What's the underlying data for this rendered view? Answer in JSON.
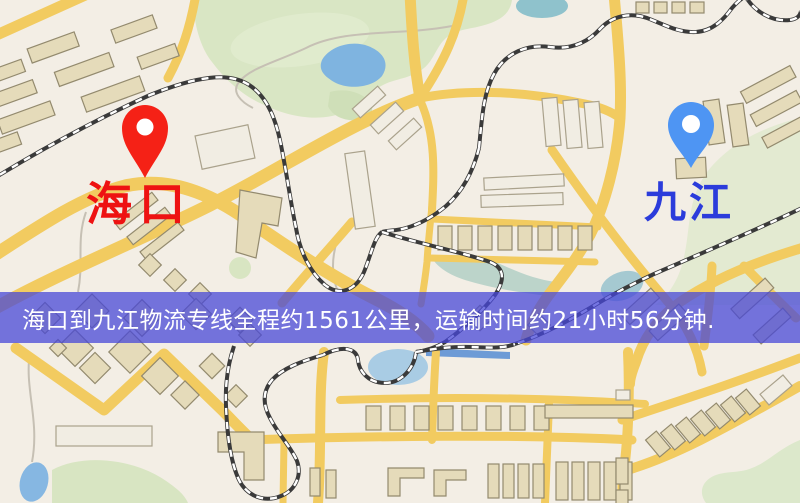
{
  "map": {
    "markers": [
      {
        "id": "origin",
        "icon": "location-pin-icon",
        "label": "海口",
        "label_color": "#ee1212",
        "pin_color": "#f52116",
        "pin_hole_color": "#ffffff"
      },
      {
        "id": "destination",
        "icon": "location-pin-icon",
        "label": "九江",
        "label_color": "#2b3cdb",
        "pin_color": "#4e95f3",
        "pin_hole_color": "#ffffff"
      }
    ],
    "banner": {
      "text": "海口到九江物流专线全程约1561公里，运输时间约21小时56分钟.",
      "text_color": "#ffffff",
      "background_hex": "#4646d8",
      "background_css": "rgba(70,70,216,0.74)"
    },
    "palette": {
      "background": "#f3eee5",
      "road": "#f2cb60",
      "park": "#d9e6c4",
      "water": "#7fb4e0",
      "river": "#6d9bd6",
      "building": "#e5dbba",
      "building_outline": "#938a6e",
      "railway": "#3a3a3a",
      "trail": "#c6c0b4"
    }
  }
}
